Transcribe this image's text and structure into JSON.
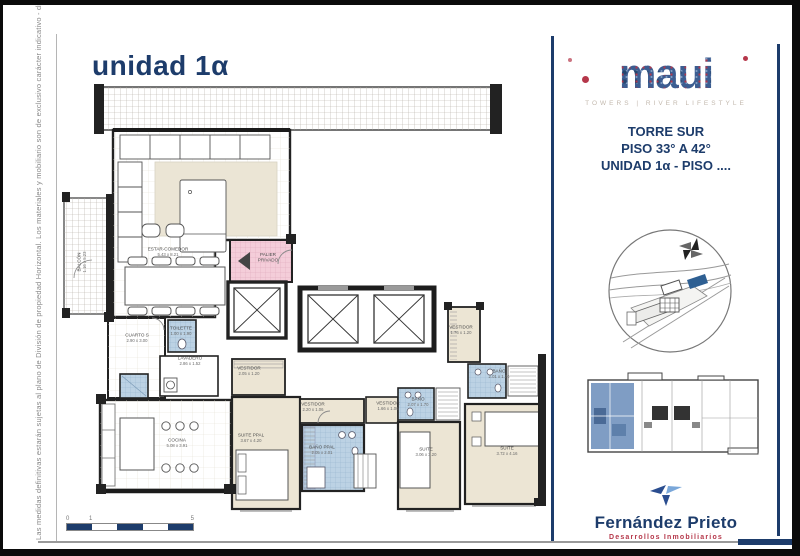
{
  "page": {
    "title": "unidad 1α",
    "disclaimer": "Las medidas definitivas estarán sujetas al plano de División de propiedad Horizontal. Los materiales y mobiliario son de exclusivo carácter indicativo - diciembre 2018"
  },
  "plan": {
    "rooms": [
      {
        "name": "ESTAR-COMEDOR",
        "dims": "5.43 x 8.21"
      },
      {
        "name": "BALCÓN",
        "dims": "1.16 x 5.23"
      },
      {
        "name": "CUARTO S",
        "dims": "2.90 x 3.00"
      },
      {
        "name": "TOILETTE",
        "dims": "1.00 x 1.90"
      },
      {
        "name": "LAVADERO",
        "dims": "2.86 x 1.52"
      },
      {
        "name": "COCINA",
        "dims": "5.08 x 3.91"
      },
      {
        "name": "SUITE PPAL",
        "dims": "3.67 x 4.20"
      },
      {
        "name": "VESTIDOR",
        "dims": "2.05 x 1.20"
      },
      {
        "name": "VESTIDOR",
        "dims": "2.20 x 1.06"
      },
      {
        "name": "VESTIDOR",
        "dims": "1.66 x 1.06"
      },
      {
        "name": "VESTIDOR",
        "dims": "1.76 x 1.20"
      },
      {
        "name": "BAÑO PPAL",
        "dims": "2.05 x 2.01"
      },
      {
        "name": "BAÑO",
        "dims": "2.07 x 1.70"
      },
      {
        "name": "BAÑO",
        "dims": "2.01 x 1.70"
      },
      {
        "name": "SUITE",
        "dims": "3.06 x 3.20"
      },
      {
        "name": "SUITE",
        "dims": "3.72 x 4.16"
      },
      {
        "name": "PALIER PRIVADO",
        "dims": ""
      }
    ],
    "scale_bar": {
      "labels": [
        "0",
        "1",
        "5"
      ]
    }
  },
  "sidebar": {
    "logo": {
      "text": "MAUI",
      "tagline": "TOWERS | RIVER LIFESTYLE"
    },
    "info": [
      "TORRE SUR",
      "PISO 33° A 42°",
      "UNIDAD 1α - PISO ...."
    ],
    "developer": {
      "name": "Fernández Prieto",
      "tagline": "Desarrollos Inmobiliarios"
    }
  },
  "colors": {
    "navy": "#1d3c6b",
    "red": "#b5374a",
    "bath": "#bcd2e4",
    "pinkc": "#f4cdd9",
    "cream": "#ece5d4",
    "wall": "#222222"
  }
}
